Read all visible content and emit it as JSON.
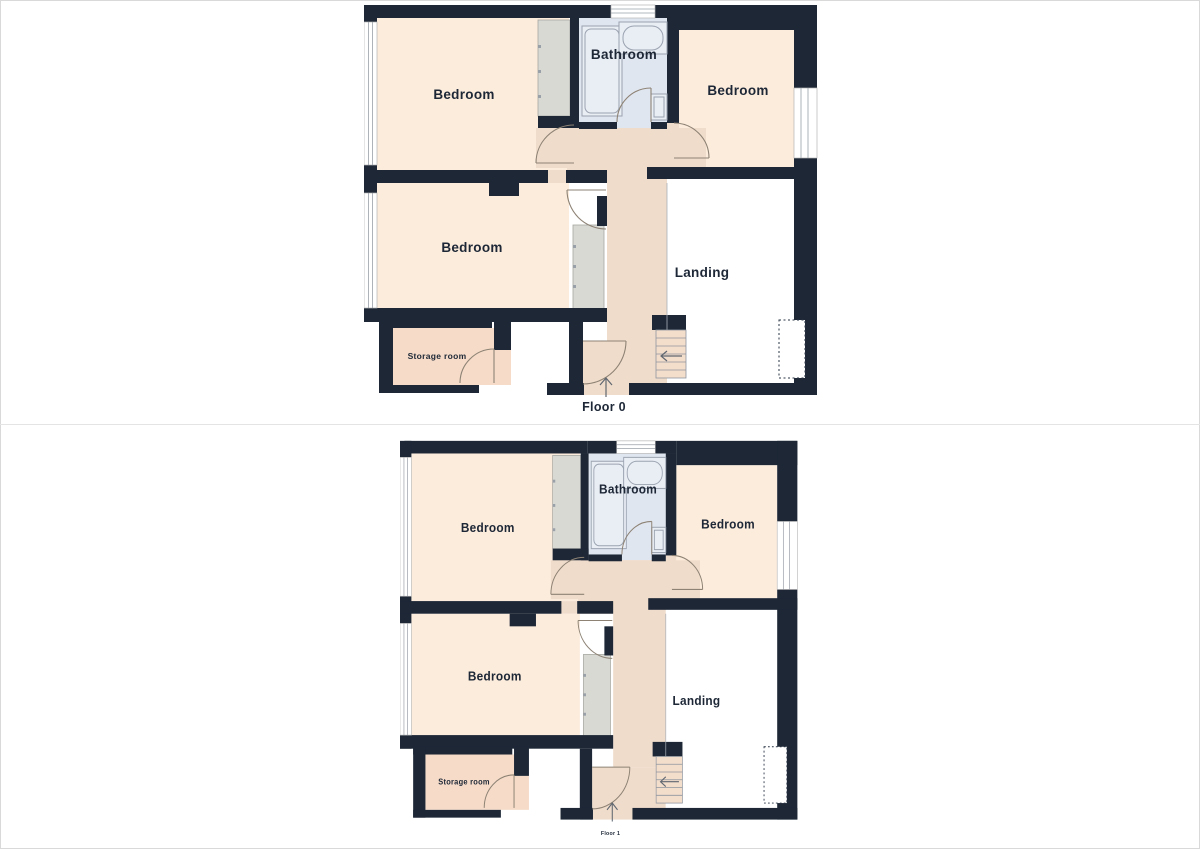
{
  "palette": {
    "wall": "#1d2736",
    "bedroom_fill": "#fcecdc",
    "hallway_fill": "#f0dccb",
    "bathroom_fill": "#e0e6f0",
    "closet_fill": "#d9d9d4",
    "storage_fill": "#f5dbc8",
    "landing_fill": "#ffffff",
    "label_text": "#1d2736"
  },
  "floors": [
    {
      "label": "Floor 0",
      "rooms": {
        "bedroom_top_left": "Bedroom",
        "bathroom": "Bathroom",
        "bedroom_top_right": "Bedroom",
        "bedroom_mid_left": "Bedroom",
        "landing": "Landing",
        "storage": "Storage room"
      }
    },
    {
      "label": "Floor 1",
      "rooms": {
        "bedroom_top_left": "Bedroom",
        "bathroom": "Bathroom",
        "bedroom_top_right": "Bedroom",
        "bedroom_mid_left": "Bedroom",
        "landing": "Landing",
        "storage": "Storage room"
      }
    }
  ]
}
